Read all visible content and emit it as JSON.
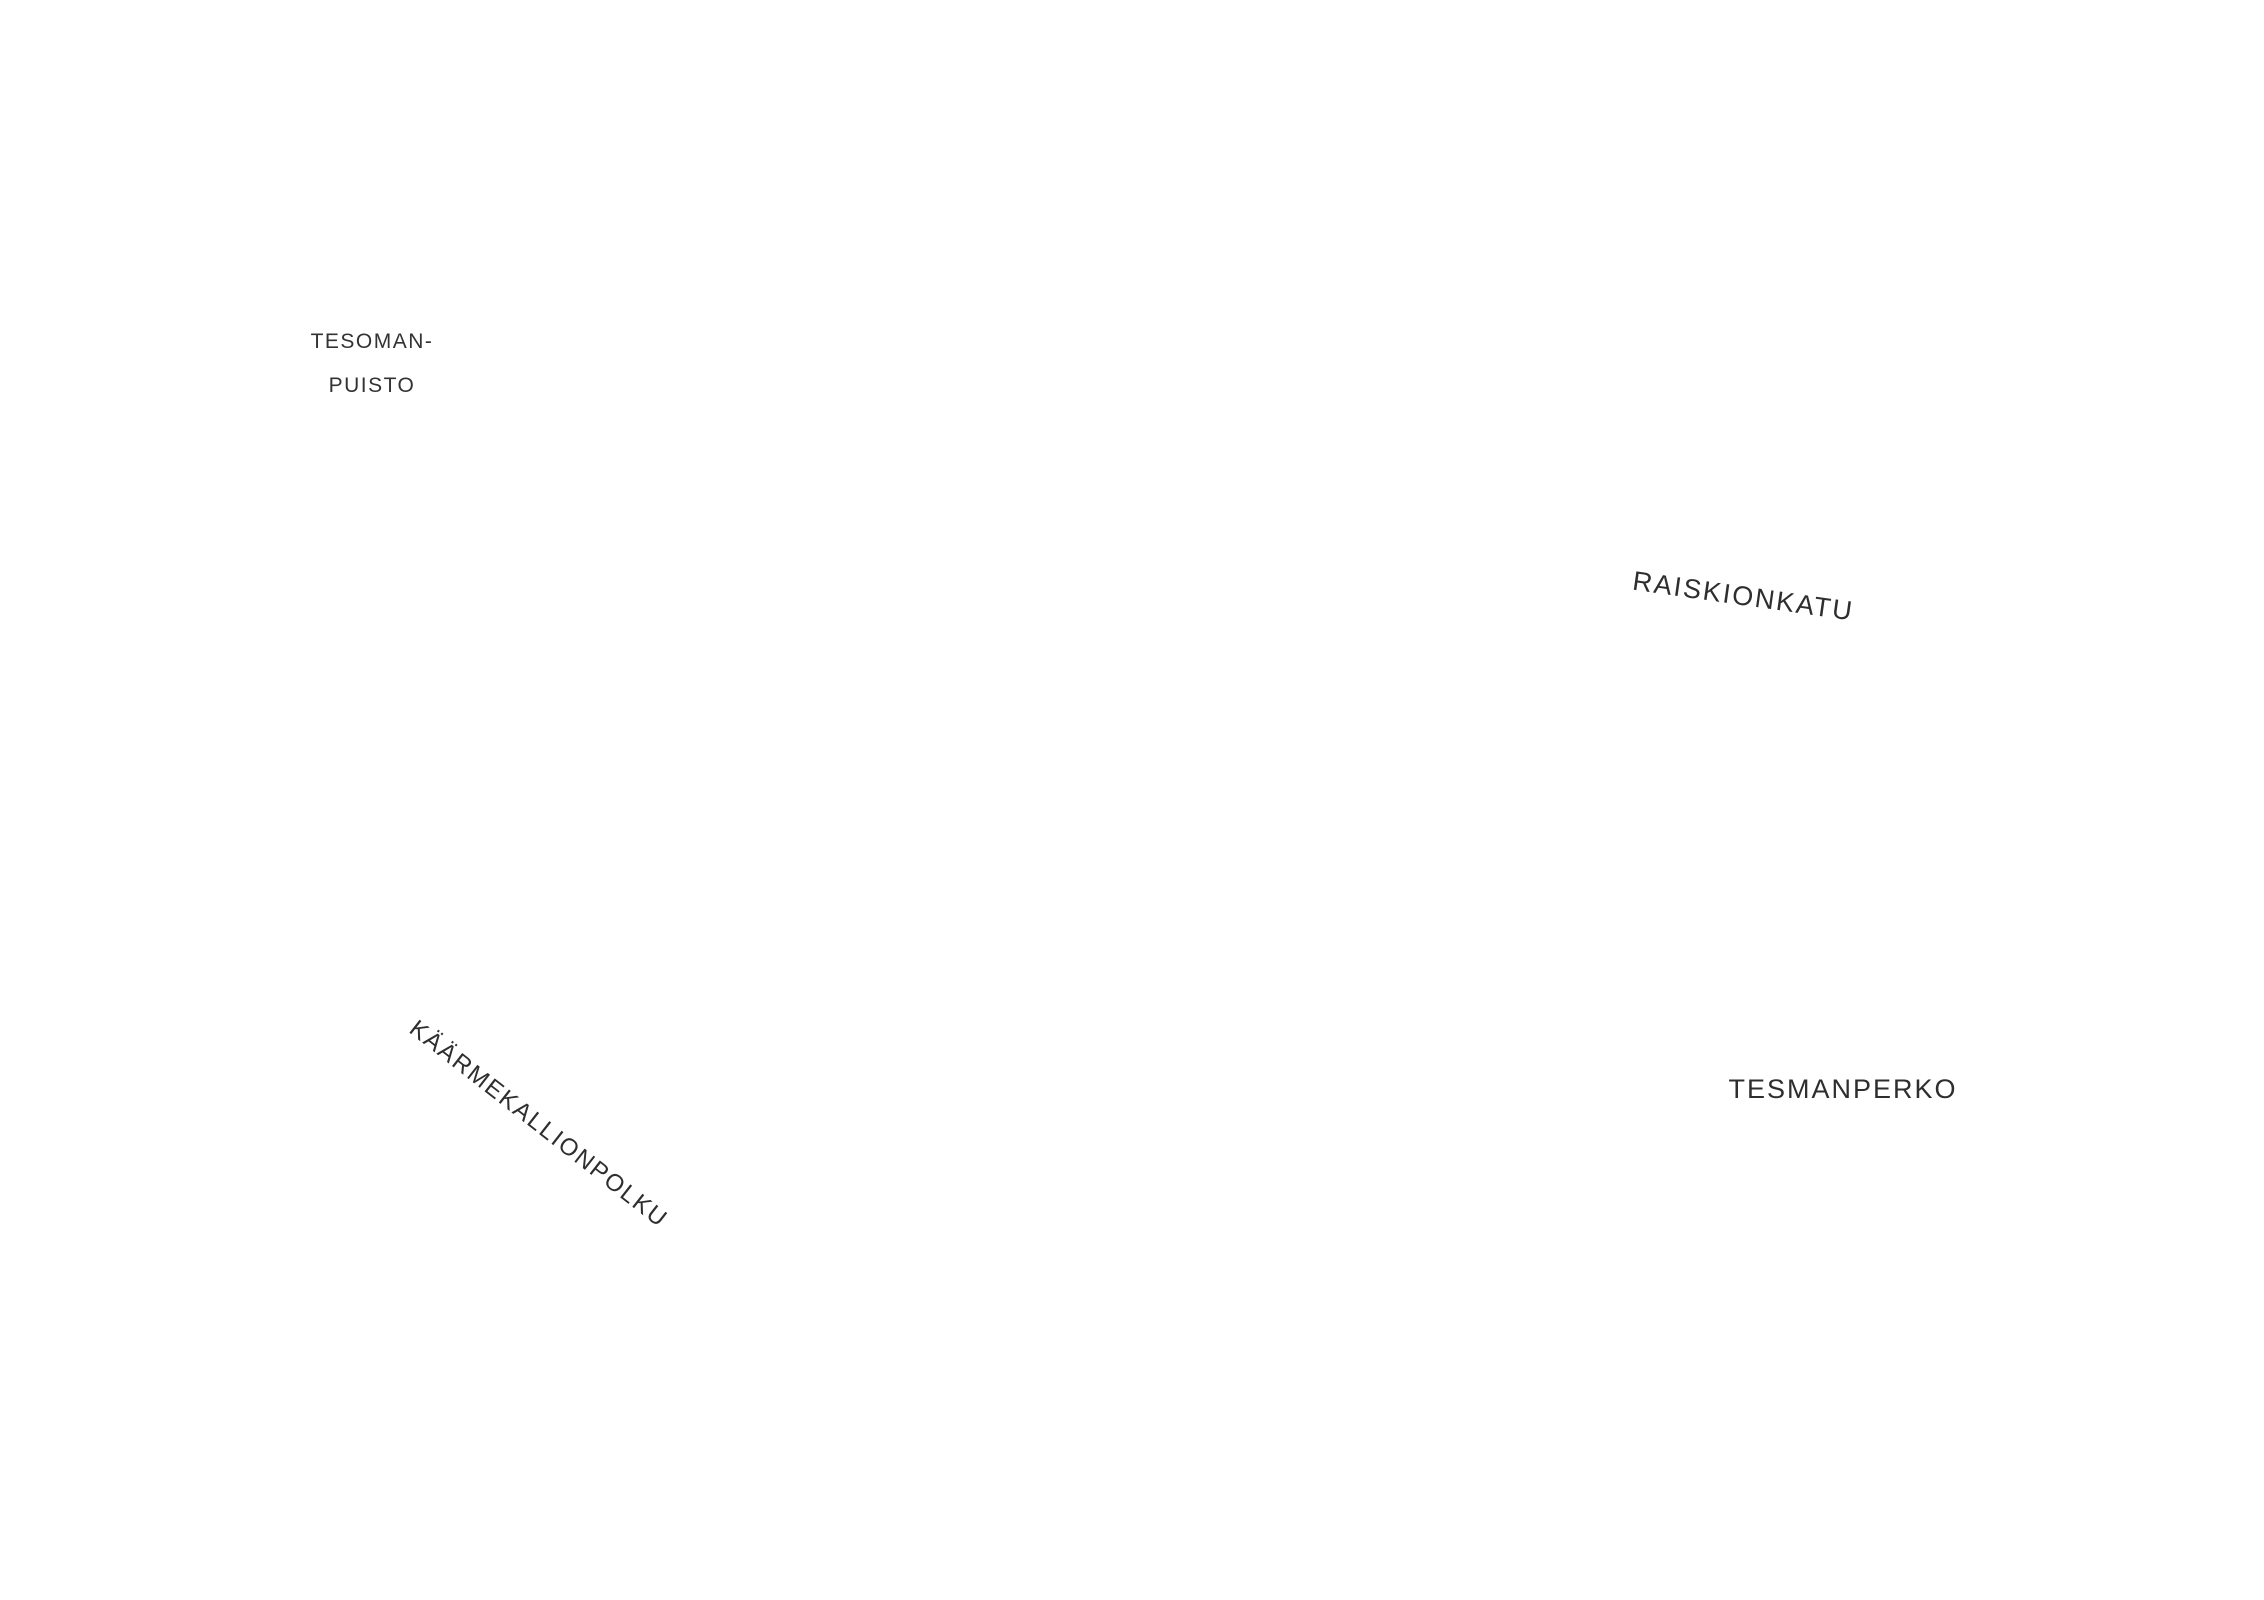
{
  "document": {
    "kind": "architectural-site-plan"
  },
  "labels": {
    "park_line1": "TESOMAN-",
    "park_line2": "PUISTO",
    "street_east": "RAISKIONKATU",
    "area_east": "TESMANPERKO",
    "path_southwest": "KÄÄRMEKALLIONPOLKU"
  },
  "parking": {
    "groups": [
      {
        "id": "stalls-1-6",
        "numbers": [
          "1",
          "2",
          "3",
          "4",
          "5",
          "6"
        ]
      },
      {
        "id": "stalls-7-8",
        "numbers": [
          "7",
          "8"
        ]
      },
      {
        "id": "stalls-9-12",
        "numbers": [
          "9",
          "10",
          "11",
          "12"
        ]
      },
      {
        "id": "stalls-13-18",
        "numbers": [
          "18",
          "17",
          "16",
          "15",
          "14",
          "13"
        ]
      },
      {
        "id": "stalls-19-25",
        "numbers": [
          "19",
          "20",
          "21",
          "22",
          "23",
          "24",
          "25"
        ]
      },
      {
        "id": "stalls-26-44",
        "numbers": [
          "26",
          "27",
          "28",
          "29",
          "30",
          "31",
          "32",
          "33",
          "34",
          "35",
          "36",
          "37",
          "38",
          "39",
          "40",
          "41",
          "42",
          "43",
          "44"
        ]
      },
      {
        "id": "stalls-45-68",
        "numbers": [
          "68",
          "67",
          "66",
          "65",
          "64",
          "63",
          "62",
          "61",
          "60",
          "59",
          "58",
          "57",
          "56",
          "55",
          "54",
          "53",
          "52",
          "51",
          "50",
          "49",
          "48",
          "47",
          "46",
          "45"
        ]
      },
      {
        "id": "stalls-69-77",
        "numbers": [
          "77",
          "76",
          "75",
          "74",
          "73",
          "72",
          "71",
          "70",
          "69"
        ]
      }
    ]
  },
  "storage": {
    "north_cluster": [
      "t127",
      "t129",
      "t128",
      "t124",
      "t126",
      "t125"
    ],
    "central_cluster_left": [
      "t119",
      "t118",
      "t120"
    ],
    "central_cluster_right": [
      "t122",
      "t121",
      "t123"
    ],
    "south_cluster": [
      "D116",
      "D115",
      "D117",
      "D114"
    ]
  },
  "colors": {
    "site_green": "#e0e6d8",
    "hedge_green": "#9aaa86",
    "tree_dark": "#75855a",
    "tree_light": "#a8b789",
    "road_tan": "#d8cbb8",
    "play_tan": "#d2c3ad",
    "parking_gray": "#b8b8b8",
    "street_dark": "#8c8c8c",
    "wall_black": "#1b1b1b",
    "contour_gray": "#b6b6b6"
  }
}
